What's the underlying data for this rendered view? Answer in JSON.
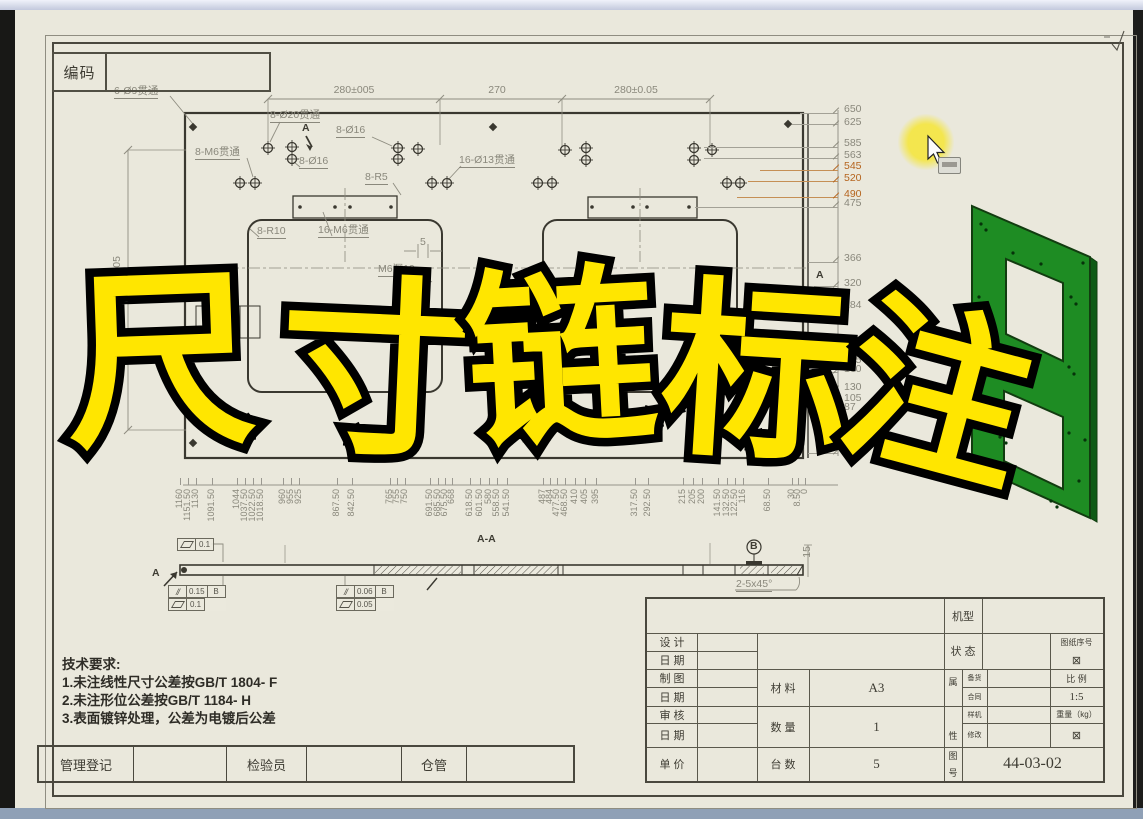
{
  "colors": {
    "sheet": "#eae8dc",
    "line_dark": "#3a3830",
    "line_dim": "#8a887c",
    "highlight": "#b5641e",
    "leader_tan": "#c58f55",
    "overlay_fill": "#ffe600",
    "overlay_stroke": "#000000",
    "green_part": "#1e8c23",
    "cursor_halo": "#f4e646",
    "bottom_bar": "#8fa0b6"
  },
  "code_box": {
    "label": "编码",
    "value": ""
  },
  "overlay": {
    "text": "尺寸链标注"
  },
  "top_dims": [
    {
      "t": "280±005",
      "x": 354,
      "y": 85
    },
    {
      "t": "270",
      "x": 497,
      "y": 85
    },
    {
      "t": "280±0.05",
      "x": 636,
      "y": 85
    }
  ],
  "annotations": [
    {
      "t": "6-Ø9贯通",
      "x": 114,
      "y": 86,
      "u": 1
    },
    {
      "t": "8-Ø20贯通",
      "x": 270,
      "y": 110,
      "u": 1
    },
    {
      "t": "8-Ø16",
      "x": 336,
      "y": 125,
      "u": 1
    },
    {
      "t": "8-M6贯通",
      "x": 195,
      "y": 147,
      "u": 1
    },
    {
      "t": "8-Ø16",
      "x": 299,
      "y": 156,
      "u": 1
    },
    {
      "t": "16-Ø13贯通",
      "x": 459,
      "y": 155,
      "u": 1
    },
    {
      "t": "8-R5",
      "x": 365,
      "y": 172,
      "u": 1
    },
    {
      "t": "8-R10",
      "x": 257,
      "y": 226,
      "u": 1
    },
    {
      "t": "16-M6贯通",
      "x": 318,
      "y": 225,
      "u": 1
    },
    {
      "t": "5",
      "x": 420,
      "y": 237
    },
    {
      "t": "M6深10",
      "x": 378,
      "y": 264,
      "u": 1
    },
    {
      "t": "A",
      "x": 302,
      "y": 123,
      "dark": 1
    },
    {
      "t": "A",
      "x": 816,
      "y": 270,
      "dark": 1
    },
    {
      "t": "A-A",
      "x": 477,
      "y": 534,
      "dark": 1
    },
    {
      "t": "A",
      "x": 152,
      "y": 568,
      "dark": 1
    },
    {
      "t": "2-5x45°",
      "x": 736,
      "y": 579,
      "u": 1
    },
    {
      "t": "15",
      "x": 802,
      "y": 546,
      "rot": 1
    },
    {
      "t": "510±0.05",
      "x": 112,
      "y": 256,
      "rot": 1
    },
    {
      "t": "B",
      "x": 750,
      "y": 541,
      "dark": 1
    }
  ],
  "right_chain": {
    "label_x": 844,
    "values": [
      {
        "v": "650",
        "y": 110
      },
      {
        "v": "625",
        "y": 123
      },
      {
        "v": "585",
        "y": 144
      },
      {
        "v": "563",
        "y": 156
      },
      {
        "v": "545",
        "y": 167,
        "h": 1
      },
      {
        "v": "520",
        "y": 179,
        "h": 1
      },
      {
        "v": "490",
        "y": 195,
        "h": 1
      },
      {
        "v": "475",
        "y": 204
      },
      {
        "v": "366",
        "y": 259
      },
      {
        "v": "320",
        "y": 284
      },
      {
        "v": "284",
        "y": 306
      },
      {
        "v": "175",
        "y": 361
      },
      {
        "v": "160",
        "y": 370
      },
      {
        "v": "130",
        "y": 388
      },
      {
        "v": "105",
        "y": 399
      },
      {
        "v": "87",
        "y": 408
      },
      {
        "v": "25",
        "y": 442
      },
      {
        "v": "0",
        "y": 451
      }
    ]
  },
  "right_leaders": [
    {
      "y": 113,
      "x": 800
    },
    {
      "y": 124,
      "x": 792
    },
    {
      "y": 147,
      "x": 704
    },
    {
      "y": 158,
      "x": 704
    },
    {
      "y": 170,
      "x": 760,
      "o": 1
    },
    {
      "y": 181,
      "x": 748,
      "o": 1
    },
    {
      "y": 197,
      "x": 737,
      "o": 1
    },
    {
      "y": 207,
      "x": 695
    },
    {
      "y": 262,
      "x": 808
    },
    {
      "y": 286,
      "x": 814
    },
    {
      "y": 309,
      "x": 814
    },
    {
      "y": 363,
      "x": 820
    },
    {
      "y": 372,
      "x": 820
    },
    {
      "y": 390,
      "x": 820
    },
    {
      "y": 401,
      "x": 820
    },
    {
      "y": 410,
      "x": 820
    },
    {
      "y": 444,
      "x": 820
    },
    {
      "y": 453,
      "x": 808
    }
  ],
  "bottom_chain": {
    "line_y": 485,
    "values": [
      {
        "v": "1160",
        "x": 180
      },
      {
        "v": "1151.50",
        "x": 188
      },
      {
        "v": "1130",
        "x": 196
      },
      {
        "v": "1091.50",
        "x": 212
      },
      {
        "v": "1044",
        "x": 237
      },
      {
        "v": "1037.50",
        "x": 245
      },
      {
        "v": "1022.50",
        "x": 253
      },
      {
        "v": "1018.50",
        "x": 261
      },
      {
        "v": "960",
        "x": 283
      },
      {
        "v": "955",
        "x": 291
      },
      {
        "v": "925",
        "x": 299
      },
      {
        "v": "867.50",
        "x": 337
      },
      {
        "v": "842.50",
        "x": 352
      },
      {
        "v": "765",
        "x": 390
      },
      {
        "v": "755",
        "x": 397
      },
      {
        "v": "750",
        "x": 405
      },
      {
        "v": "691.50",
        "x": 430
      },
      {
        "v": "685.50",
        "x": 438
      },
      {
        "v": "675.50",
        "x": 445
      },
      {
        "v": "668",
        "x": 452
      },
      {
        "v": "618.50",
        "x": 470
      },
      {
        "v": "601.50",
        "x": 480
      },
      {
        "v": "580",
        "x": 489
      },
      {
        "v": "558.50",
        "x": 497
      },
      {
        "v": "541.50",
        "x": 507
      },
      {
        "v": "487",
        "x": 543
      },
      {
        "v": "484",
        "x": 550
      },
      {
        "v": "477.50",
        "x": 557
      },
      {
        "v": "468.50",
        "x": 565
      },
      {
        "v": "410",
        "x": 575
      },
      {
        "v": "405",
        "x": 585
      },
      {
        "v": "395",
        "x": 596
      },
      {
        "v": "317.50",
        "x": 635
      },
      {
        "v": "292.50",
        "x": 648
      },
      {
        "v": "215",
        "x": 683
      },
      {
        "v": "205",
        "x": 693
      },
      {
        "v": "200",
        "x": 702
      },
      {
        "v": "141.50",
        "x": 718
      },
      {
        "v": "132.50",
        "x": 727
      },
      {
        "v": "122.50",
        "x": 735
      },
      {
        "v": "116",
        "x": 743
      },
      {
        "v": "68.50",
        "x": 768
      },
      {
        "v": "30",
        "x": 792
      },
      {
        "v": "8.50",
        "x": 798
      },
      {
        "v": "0",
        "x": 805
      }
    ]
  },
  "gdt_frames": [
    {
      "x": 177,
      "y": 538,
      "rows": [
        [
          {
            "icon": "flatness"
          },
          {
            "text": "0.1"
          }
        ]
      ]
    },
    {
      "x": 168,
      "y": 585,
      "rows": [
        [
          {
            "icon": "parallelism"
          },
          {
            "text": "0.15"
          },
          {
            "text": "B"
          }
        ],
        [
          {
            "icon": "flatness"
          },
          {
            "text": "0.1"
          }
        ]
      ]
    },
    {
      "x": 336,
      "y": 585,
      "rows": [
        [
          {
            "icon": "parallelism"
          },
          {
            "text": "0.06"
          },
          {
            "text": "B"
          }
        ],
        [
          {
            "icon": "flatness"
          },
          {
            "text": "0.05"
          }
        ]
      ]
    }
  ],
  "tech_requirements": {
    "title": "技术要求:",
    "items": [
      "1.未注线性尺寸公差按GB/T 1804- F",
      "2.未注形位公差按GB/T 1184- H",
      "3.表面镀锌处理，公差为电镀后公差"
    ]
  },
  "bottom_row": {
    "cells": [
      "管理登记",
      "",
      "检验员",
      "",
      "仓管",
      ""
    ]
  },
  "title_block": {
    "machine_model_label": "机型",
    "rows_left": [
      "设 计",
      "日 期",
      "制 图",
      "日 期",
      "审 核",
      "日 期",
      "单 价"
    ],
    "material_label": "材 料",
    "material_value": "A3",
    "quantity_label": "数 量",
    "quantity_value": "1",
    "units_label": "台 数",
    "units_value": "5",
    "status_label": "状 态",
    "drawing_no_label": "图纸序号",
    "drawing_no_mark": "⊠",
    "attr_label_top": "属",
    "attr_label_bottom": "性",
    "attr_rows": [
      "备货",
      "合同",
      "样机",
      "修改"
    ],
    "scale_label": "比 例",
    "scale_value": "1:5",
    "weight_label": "重量（kg）",
    "weight_mark": "⊠",
    "fig_label_top": "图",
    "fig_label_bottom": "号",
    "fig_no": "44-03-02"
  }
}
